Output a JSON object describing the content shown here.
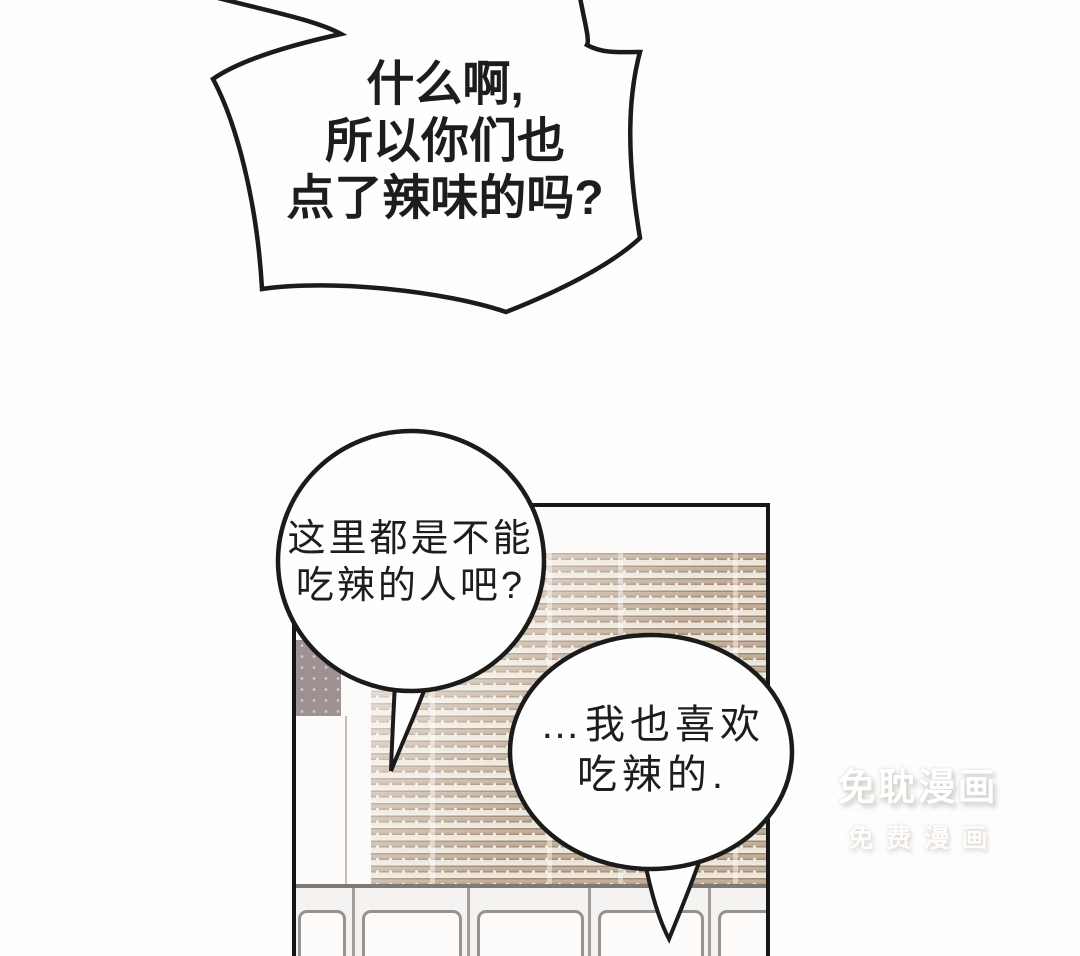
{
  "dialogue": {
    "shout": {
      "lines": [
        "什么啊,",
        "所以你们也",
        "点了辣味的吗?"
      ]
    },
    "bubble_left": {
      "lines": [
        "这里都是不能",
        "吃辣的人吧?"
      ]
    },
    "bubble_right": {
      "lines": [
        "…我也喜欢",
        "吃辣的."
      ]
    }
  },
  "watermark": {
    "title": "免耽漫画",
    "subtitle": "免费漫画"
  },
  "colors": {
    "ink": "#1c1c1c",
    "page_background": "#fdfdfd",
    "blind_slat": "#bfa892",
    "blind_gap": "#f1eadf",
    "wall_tile": "#9e9192",
    "chair_outline": "#96928e",
    "watermark_white": "#ffffff"
  }
}
